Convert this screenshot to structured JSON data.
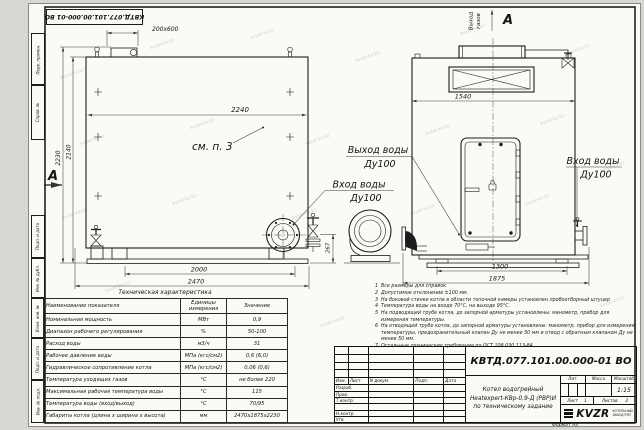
{
  "page": {
    "watermark": "kvzar-kv.kz",
    "format_label": "Формат А3",
    "corner_stamp": "КВТД.077.101.00.000-01 ВО",
    "colors": {
      "paper": "#fbfaf6",
      "background": "#d9d7d1",
      "line": "#1c1c1c"
    }
  },
  "frame": {
    "left_labels": [
      "Перв. примен.",
      "Справ. №",
      "Подп. и дата",
      "Инв. № дубл.",
      "Взам. инв. №",
      "Подп. и дата",
      "Инв. № подл."
    ]
  },
  "drawing": {
    "side_view": {
      "dim_opening": "200х600",
      "dim_width_top": "2240",
      "dim_height_total": "2230",
      "dim_height_body": "2140",
      "dim_supports": "2000",
      "dim_length_overall": "2470",
      "dim_nozzle_height": "267",
      "see_note": "см. п. 3",
      "section_label": "А"
    },
    "front_view": {
      "dim_width": "1540",
      "dim_base": "1300",
      "dim_width_overall": "1875",
      "gas_outlet_line1": "Выход",
      "gas_outlet_line2": "газов",
      "view_label": "А"
    },
    "labels": {
      "water_outlet_line1": "Выход воды",
      "water_outlet_line2": "Ду100",
      "water_inlet_line1": "Вход воды",
      "water_inlet_line2": "Ду100",
      "water_inlet_right_line1": "Вход воды",
      "water_inlet_right_line2": "Ду100"
    }
  },
  "notes": {
    "items": [
      {
        "num": "1",
        "text": "Все размеры для справок"
      },
      {
        "num": "2",
        "text": "Допустимое отклонение ±100 мм."
      },
      {
        "num": "3",
        "text": "На боковой стенке котла в области топочной камеры установлен пробоотборный штуцер"
      },
      {
        "num": "4",
        "text": "Температура воды на входе 70°С, на выходе 95°С."
      },
      {
        "num": "5",
        "text": "На подводящей трубе котла, до запорной арматуры установлены: манометр, прибор для измерения температуры."
      },
      {
        "num": "6",
        "text": "На отводящей трубе котла, до запорной арматуры установлены: манометр, прибор для измерения температуры, предохранительный клапан Ду не менее 50 мм и отвод с обратным клапаном Ду не менее 50 мм."
      },
      {
        "num": "7",
        "text": "Остальные технические требования по ОСТ 108.030.113-84"
      }
    ]
  },
  "spec_table": {
    "title": "Техническая характеристика",
    "headers": [
      "Наименование показателя",
      "Единицы измерения",
      "Значение"
    ],
    "rows": [
      [
        "Номинальная мощность",
        "МВт",
        "0,9"
      ],
      [
        "Диапазон рабочего регулирования",
        "%",
        "50-100"
      ],
      [
        "Расход воды",
        "м3/ч",
        "31"
      ],
      [
        "Рабочее давление воды",
        "МПа (кгс/см2)",
        "0,6 (6,0)"
      ],
      [
        "Гидравлическое сопротивление котла",
        "МПа (кгс/см2)",
        "0,06 (0,6)"
      ],
      [
        "Температура уходящих газов",
        "°С",
        "не более 220"
      ],
      [
        "Максимальная рабочая температура воды",
        "°С",
        "115"
      ],
      [
        "Температура воды (вход/выход)",
        "°С",
        "70/95"
      ],
      [
        "Габариты котла (длина х ширина х высота)",
        "мм",
        "2470х1875х2230"
      ]
    ]
  },
  "title_block": {
    "doc_number": "КВТД.077.101.00.000-01 ВО",
    "product_line1": "Котел водогрейный",
    "product_line2": "Heatexpert-КВр-0,9-Д (РВР)И",
    "product_line3": "по техническому задание",
    "header_cells": [
      "Изм.",
      "Лист",
      "N докум.",
      "Подп.",
      "Дата"
    ],
    "roles": [
      "Разраб.",
      "Пров.",
      "Т.контр.",
      "",
      "Н.контр.",
      "Утв."
    ],
    "lit_label": "Лит.",
    "mass_label": "Масса",
    "scale_label": "Масштаб",
    "scale_value": "1:15",
    "sheet_label": "Лист",
    "sheet_value": "1",
    "sheets_label": "Листов",
    "sheets_value": "2",
    "logo_text": "KVZR",
    "logo_sub1": "КОТЕЛЬНЫЙ",
    "logo_sub2": "ЗАВОД РЭП"
  }
}
